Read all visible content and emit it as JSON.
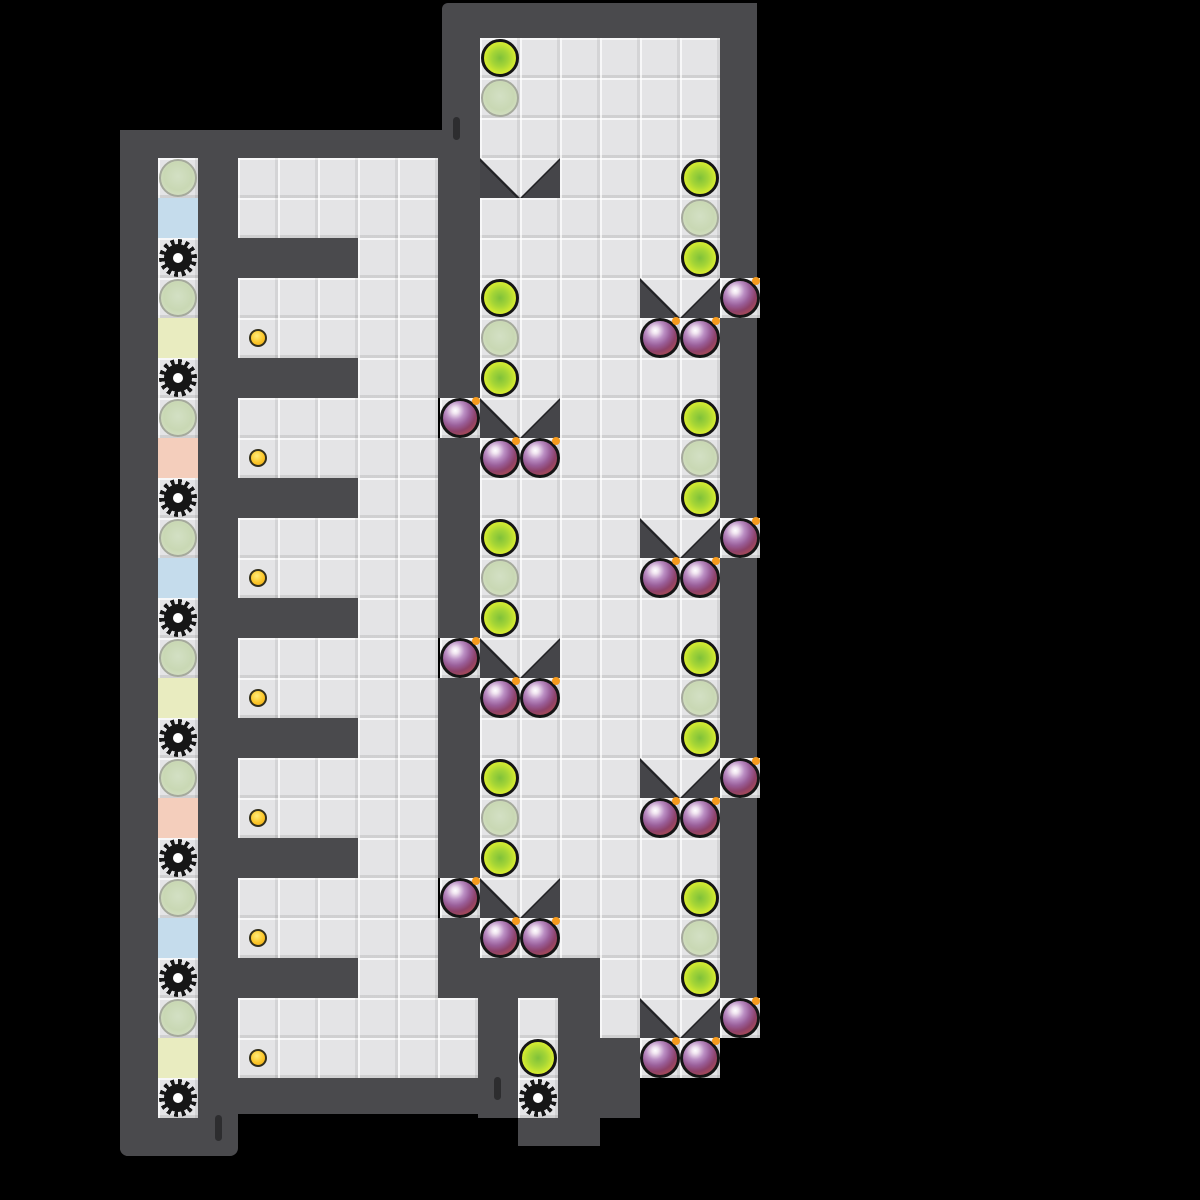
{
  "palette": {
    "background": "#000000",
    "wall": "#4a4a4d",
    "wall_edge": "#232326",
    "floor": "#e4e4e6",
    "gate": "#454549",
    "bright_orb": "#dcee32",
    "bright_orb_core": "#7fc13a",
    "faded_orb": "#cdd9ba",
    "bomb_body": "#9a5f9a",
    "bomb_fuse": "#f59a1e",
    "coin": "#fbc629",
    "gear": "#161616",
    "tile_blue": "#c5dcec",
    "tile_yellow": "#e9ecc0",
    "tile_pink": "#f4cebc"
  },
  "level": {
    "tile_size": 40,
    "floors": [
      {
        "x": 158,
        "y": 158,
        "w": 40,
        "h": 960
      },
      {
        "x": 238,
        "y": 158,
        "w": 200,
        "h": 920
      },
      {
        "x": 438,
        "y": 998,
        "w": 40,
        "h": 80
      },
      {
        "x": 480,
        "y": 38,
        "w": 240,
        "h": 920
      },
      {
        "x": 600,
        "y": 958,
        "w": 120,
        "h": 80
      },
      {
        "x": 640,
        "y": 1038,
        "w": 80,
        "h": 40
      },
      {
        "x": 518,
        "y": 998,
        "w": 40,
        "h": 120
      },
      {
        "x": 720,
        "y": 278,
        "w": 40,
        "h": 40
      },
      {
        "x": 720,
        "y": 518,
        "w": 40,
        "h": 40
      },
      {
        "x": 720,
        "y": 758,
        "w": 40,
        "h": 40
      },
      {
        "x": 720,
        "y": 998,
        "w": 40,
        "h": 40
      },
      {
        "x": 440,
        "y": 398,
        "w": 40,
        "h": 40
      },
      {
        "x": 440,
        "y": 638,
        "w": 40,
        "h": 40
      },
      {
        "x": 440,
        "y": 878,
        "w": 40,
        "h": 40
      }
    ],
    "walls": [
      {
        "x": 120,
        "y": 130,
        "w": 38,
        "h": 1026,
        "r": "8px 0 0 8px"
      },
      {
        "x": 120,
        "y": 130,
        "w": 360,
        "h": 28
      },
      {
        "x": 198,
        "y": 158,
        "w": 40,
        "h": 960
      },
      {
        "x": 120,
        "y": 1118,
        "w": 118,
        "h": 38,
        "r": "0 0 8px 8px"
      },
      {
        "x": 238,
        "y": 1078,
        "w": 240,
        "h": 36
      },
      {
        "x": 238,
        "y": 238,
        "w": 120,
        "h": 40
      },
      {
        "x": 238,
        "y": 358,
        "w": 120,
        "h": 40
      },
      {
        "x": 238,
        "y": 478,
        "w": 120,
        "h": 40
      },
      {
        "x": 238,
        "y": 598,
        "w": 120,
        "h": 40
      },
      {
        "x": 238,
        "y": 718,
        "w": 120,
        "h": 40
      },
      {
        "x": 238,
        "y": 838,
        "w": 120,
        "h": 40
      },
      {
        "x": 238,
        "y": 958,
        "w": 120,
        "h": 40
      },
      {
        "x": 438,
        "y": 158,
        "w": 42,
        "h": 240
      },
      {
        "x": 438,
        "y": 438,
        "w": 42,
        "h": 200
      },
      {
        "x": 438,
        "y": 678,
        "w": 42,
        "h": 200
      },
      {
        "x": 438,
        "y": 918,
        "w": 42,
        "h": 80
      },
      {
        "x": 442,
        "y": 3,
        "w": 315,
        "h": 35,
        "r": "6px 6px 0 0"
      },
      {
        "x": 442,
        "y": 38,
        "w": 38,
        "h": 120
      },
      {
        "x": 720,
        "y": 3,
        "w": 37,
        "h": 275
      },
      {
        "x": 720,
        "y": 318,
        "w": 37,
        "h": 200
      },
      {
        "x": 720,
        "y": 558,
        "w": 37,
        "h": 200
      },
      {
        "x": 720,
        "y": 798,
        "w": 37,
        "h": 200
      },
      {
        "x": 478,
        "y": 958,
        "w": 40,
        "h": 160
      },
      {
        "x": 518,
        "y": 958,
        "w": 40,
        "h": 40
      },
      {
        "x": 558,
        "y": 958,
        "w": 42,
        "h": 160
      },
      {
        "x": 598,
        "y": 1038,
        "w": 42,
        "h": 80
      },
      {
        "x": 518,
        "y": 1118,
        "w": 82,
        "h": 28
      }
    ],
    "gates": [
      {
        "x": 480,
        "y": 158
      },
      {
        "x": 640,
        "y": 278
      },
      {
        "x": 480,
        "y": 398
      },
      {
        "x": 640,
        "y": 518
      },
      {
        "x": 480,
        "y": 638
      },
      {
        "x": 640,
        "y": 758
      },
      {
        "x": 480,
        "y": 878
      },
      {
        "x": 640,
        "y": 998
      }
    ],
    "bright_orbs": [
      {
        "x": 500,
        "y": 58
      },
      {
        "x": 500,
        "y": 298
      },
      {
        "x": 500,
        "y": 378
      },
      {
        "x": 500,
        "y": 538
      },
      {
        "x": 500,
        "y": 618
      },
      {
        "x": 500,
        "y": 778
      },
      {
        "x": 500,
        "y": 858
      },
      {
        "x": 700,
        "y": 178
      },
      {
        "x": 700,
        "y": 258
      },
      {
        "x": 700,
        "y": 418
      },
      {
        "x": 700,
        "y": 498
      },
      {
        "x": 700,
        "y": 658
      },
      {
        "x": 700,
        "y": 738
      },
      {
        "x": 700,
        "y": 898
      },
      {
        "x": 700,
        "y": 978
      },
      {
        "x": 538,
        "y": 1058
      }
    ],
    "faded_orbs": [
      {
        "x": 178,
        "y": 178
      },
      {
        "x": 178,
        "y": 298
      },
      {
        "x": 178,
        "y": 418
      },
      {
        "x": 178,
        "y": 538
      },
      {
        "x": 178,
        "y": 658
      },
      {
        "x": 178,
        "y": 778
      },
      {
        "x": 178,
        "y": 898
      },
      {
        "x": 178,
        "y": 1018
      },
      {
        "x": 500,
        "y": 98
      },
      {
        "x": 500,
        "y": 338
      },
      {
        "x": 500,
        "y": 578
      },
      {
        "x": 500,
        "y": 818
      },
      {
        "x": 700,
        "y": 218
      },
      {
        "x": 700,
        "y": 458
      },
      {
        "x": 700,
        "y": 698
      },
      {
        "x": 700,
        "y": 938
      }
    ],
    "bombs": [
      {
        "x": 660,
        "y": 338
      },
      {
        "x": 700,
        "y": 338
      },
      {
        "x": 500,
        "y": 458
      },
      {
        "x": 540,
        "y": 458
      },
      {
        "x": 660,
        "y": 578
      },
      {
        "x": 700,
        "y": 578
      },
      {
        "x": 500,
        "y": 698
      },
      {
        "x": 540,
        "y": 698
      },
      {
        "x": 660,
        "y": 818
      },
      {
        "x": 700,
        "y": 818
      },
      {
        "x": 500,
        "y": 938
      },
      {
        "x": 540,
        "y": 938
      },
      {
        "x": 660,
        "y": 1058
      },
      {
        "x": 700,
        "y": 1058
      },
      {
        "x": 740,
        "y": 298
      },
      {
        "x": 740,
        "y": 538
      },
      {
        "x": 740,
        "y": 778
      },
      {
        "x": 740,
        "y": 1018
      },
      {
        "x": 460,
        "y": 418
      },
      {
        "x": 460,
        "y": 658
      },
      {
        "x": 460,
        "y": 898
      }
    ],
    "gears": [
      {
        "x": 178,
        "y": 258
      },
      {
        "x": 178,
        "y": 378
      },
      {
        "x": 178,
        "y": 498
      },
      {
        "x": 178,
        "y": 618
      },
      {
        "x": 178,
        "y": 738
      },
      {
        "x": 178,
        "y": 858
      },
      {
        "x": 178,
        "y": 978
      },
      {
        "x": 178,
        "y": 1098
      },
      {
        "x": 538,
        "y": 1098
      }
    ],
    "coins": [
      {
        "x": 258,
        "y": 338
      },
      {
        "x": 258,
        "y": 458
      },
      {
        "x": 258,
        "y": 578
      },
      {
        "x": 258,
        "y": 698
      },
      {
        "x": 258,
        "y": 818
      },
      {
        "x": 258,
        "y": 938
      },
      {
        "x": 258,
        "y": 1058
      }
    ],
    "color_tiles": [
      {
        "x": 158,
        "y": 198,
        "c": "tile_blue"
      },
      {
        "x": 158,
        "y": 318,
        "c": "tile_yellow"
      },
      {
        "x": 158,
        "y": 438,
        "c": "tile_pink"
      },
      {
        "x": 158,
        "y": 558,
        "c": "tile_blue"
      },
      {
        "x": 158,
        "y": 678,
        "c": "tile_yellow"
      },
      {
        "x": 158,
        "y": 798,
        "c": "tile_pink"
      },
      {
        "x": 158,
        "y": 918,
        "c": "tile_blue"
      },
      {
        "x": 158,
        "y": 1038,
        "c": "tile_yellow"
      }
    ],
    "door_marks": [
      {
        "x": 453,
        "y": 117,
        "h": 23
      },
      {
        "x": 215,
        "y": 1115,
        "h": 26
      },
      {
        "x": 494,
        "y": 1077,
        "h": 23
      }
    ]
  }
}
